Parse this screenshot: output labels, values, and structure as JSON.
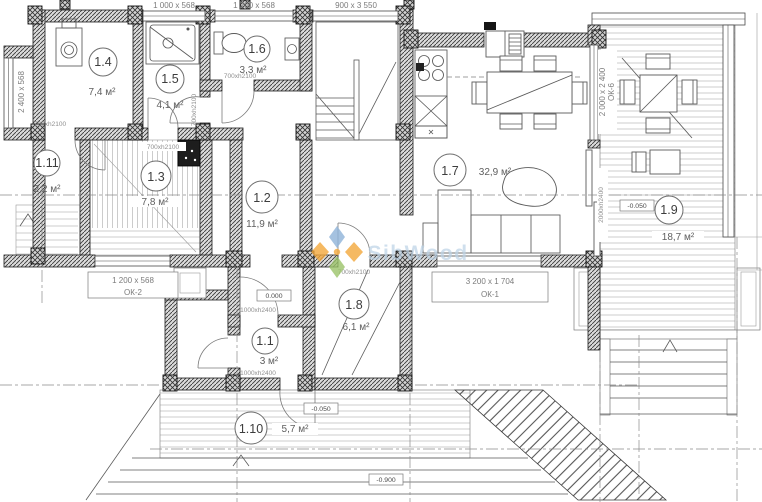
{
  "watermark": {
    "text": "SibWood"
  },
  "rooms": {
    "r11": {
      "num": "1.1",
      "area": "3 м²"
    },
    "r12": {
      "num": "1.2",
      "area": "11,9 м²"
    },
    "r13": {
      "num": "1.3",
      "area": "7,8 м²"
    },
    "r14": {
      "num": "1.4",
      "area": "7,4 м²"
    },
    "r15": {
      "num": "1.5",
      "area": "4,1 м²"
    },
    "r16": {
      "num": "1.6",
      "area": "3,3 м²"
    },
    "r17": {
      "num": "1.7",
      "area": "32,9 м²"
    },
    "r18": {
      "num": "1.8",
      "area": "6,1 м²"
    },
    "r19": {
      "num": "1.9",
      "area": "18,7 м²"
    },
    "r110": {
      "num": "1.10",
      "area": "5,7 м²"
    },
    "r111": {
      "num": "1.11",
      "area": "2,2 м²"
    }
  },
  "windows": {
    "w1000": "1 000 x 568",
    "w1200": "1 200 x 568",
    "w900": "900 x 3 550",
    "w2400": "2 400 x 568",
    "ok1_size": "3 200 x 1 704",
    "ok1_name": "ОК-1",
    "ok2_size": "1 200 x 568",
    "ok2_name": "ОК-2",
    "ok6_size": "2 000 x 2 400",
    "ok6_name": "ОК-6"
  },
  "doors": {
    "d700": "700xh2100",
    "d1000": "1000xh2400",
    "d2000": "2000xh2400"
  },
  "levels": {
    "zero": "0.000",
    "m050": "-0.050",
    "m900": "-0.900"
  }
}
